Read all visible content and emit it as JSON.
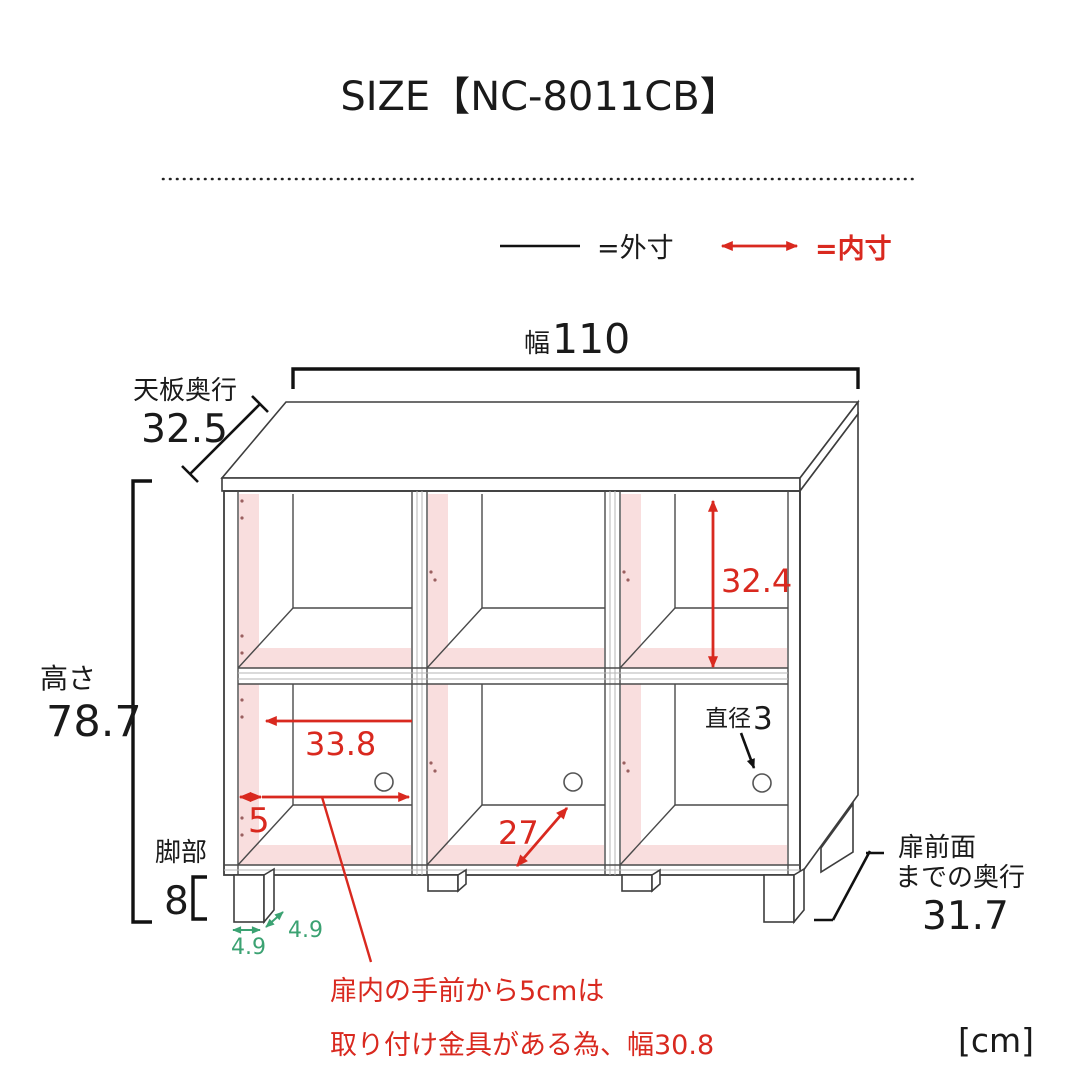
{
  "title": "SIZE【NC-8011CB】",
  "unit": "[cm]",
  "colors": {
    "dimension_red": "#d9291f",
    "leg_green": "#3ba272",
    "interior_pink": "#f9dede",
    "line_black": "#1a1a1a"
  },
  "legend": {
    "outer_label": "=外寸",
    "inner_label": "=内寸"
  },
  "dims": {
    "width_prefix": "幅",
    "width_value": "110",
    "top_depth_label": "天板奥行",
    "top_depth_value": "32.5",
    "height_label": "高さ",
    "height_value": "78.7",
    "inner_height": "32.4",
    "inner_width": "33.8",
    "front_gap": "5",
    "inner_depth": "27",
    "hole_label": "直径",
    "hole_value": "3",
    "leg_label": "脚部",
    "leg_value": "8",
    "leg_width": "4.9",
    "leg_depth": "4.9",
    "door_depth_label_1": "扉前面",
    "door_depth_label_2": "までの奥行",
    "door_depth_value": "31.7"
  },
  "note": {
    "line1": "扉内の手前から5cmは",
    "line2": "取り付け金具がある為、幅30.8"
  }
}
